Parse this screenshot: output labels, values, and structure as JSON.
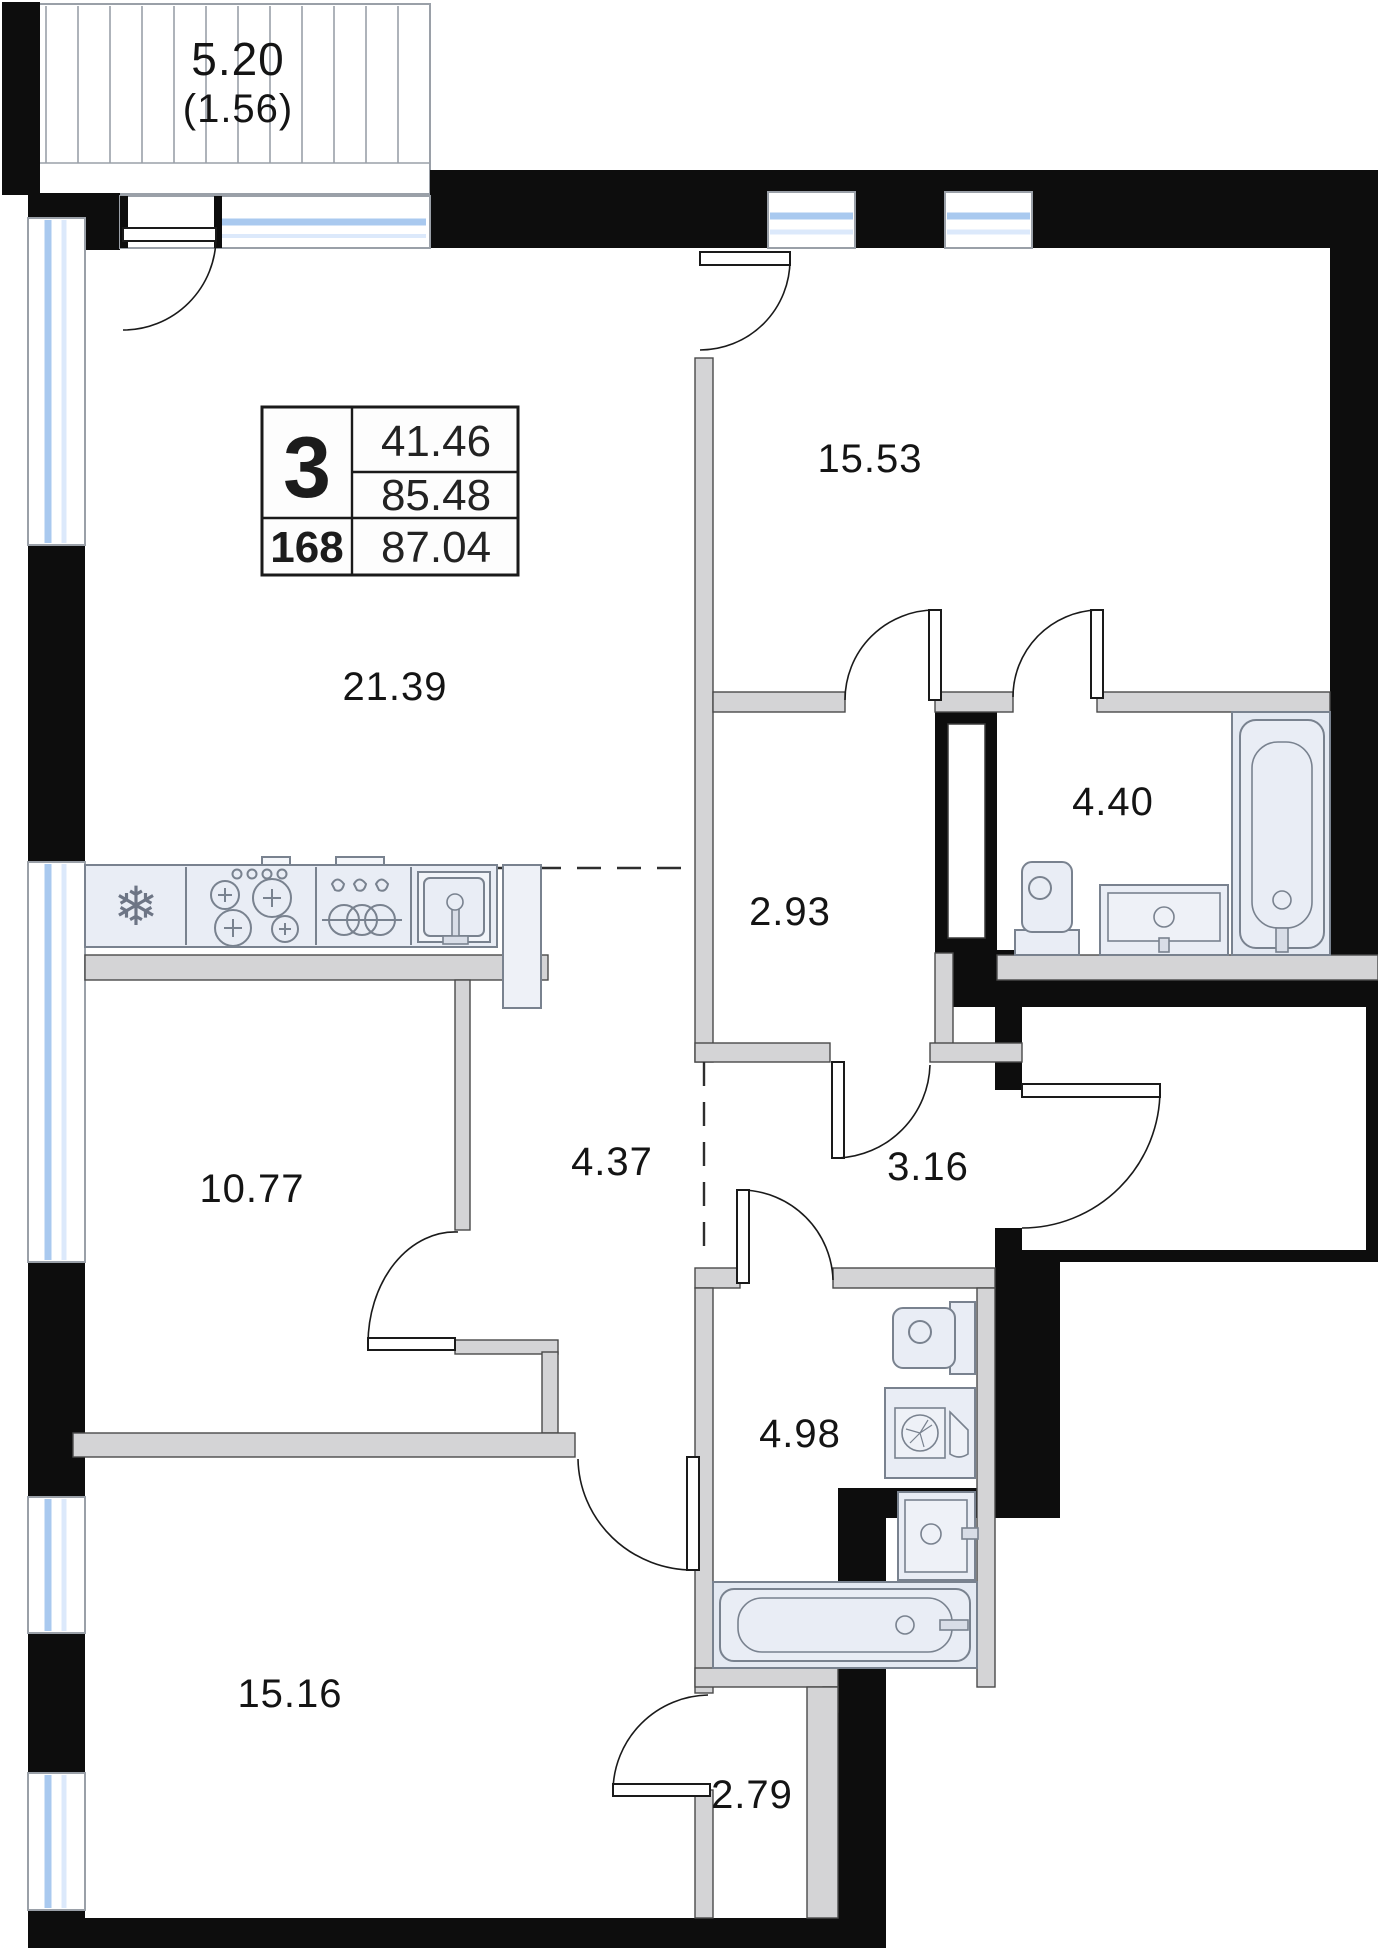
{
  "plan": {
    "balcony": {
      "area": "5.20",
      "area_note": "(1.56)"
    },
    "info_box": {
      "rooms_count": "3",
      "living_area": "41.46",
      "area_no_balcony": "85.48",
      "flat_number": "168",
      "total_area": "87.04"
    },
    "rooms": {
      "bedroom_top": "15.53",
      "living_kitchen": "21.39",
      "bathroom_main": "4.40",
      "hall_upper": "2.93",
      "bedroom_left": "10.77",
      "corridor": "4.37",
      "hallway_center": "3.16",
      "bathroom_second": "4.98",
      "bedroom_bottom": "15.16",
      "corridor_lower": "2.79"
    },
    "icons": {
      "fridge": "❄"
    },
    "colors": {
      "exterior_wall": "#0d0d0d",
      "partition": "#d4d4d6",
      "window_glass": "#a9c9ef",
      "fixture_fill": "#e9edf5",
      "fixture_stroke": "#79828f"
    }
  }
}
